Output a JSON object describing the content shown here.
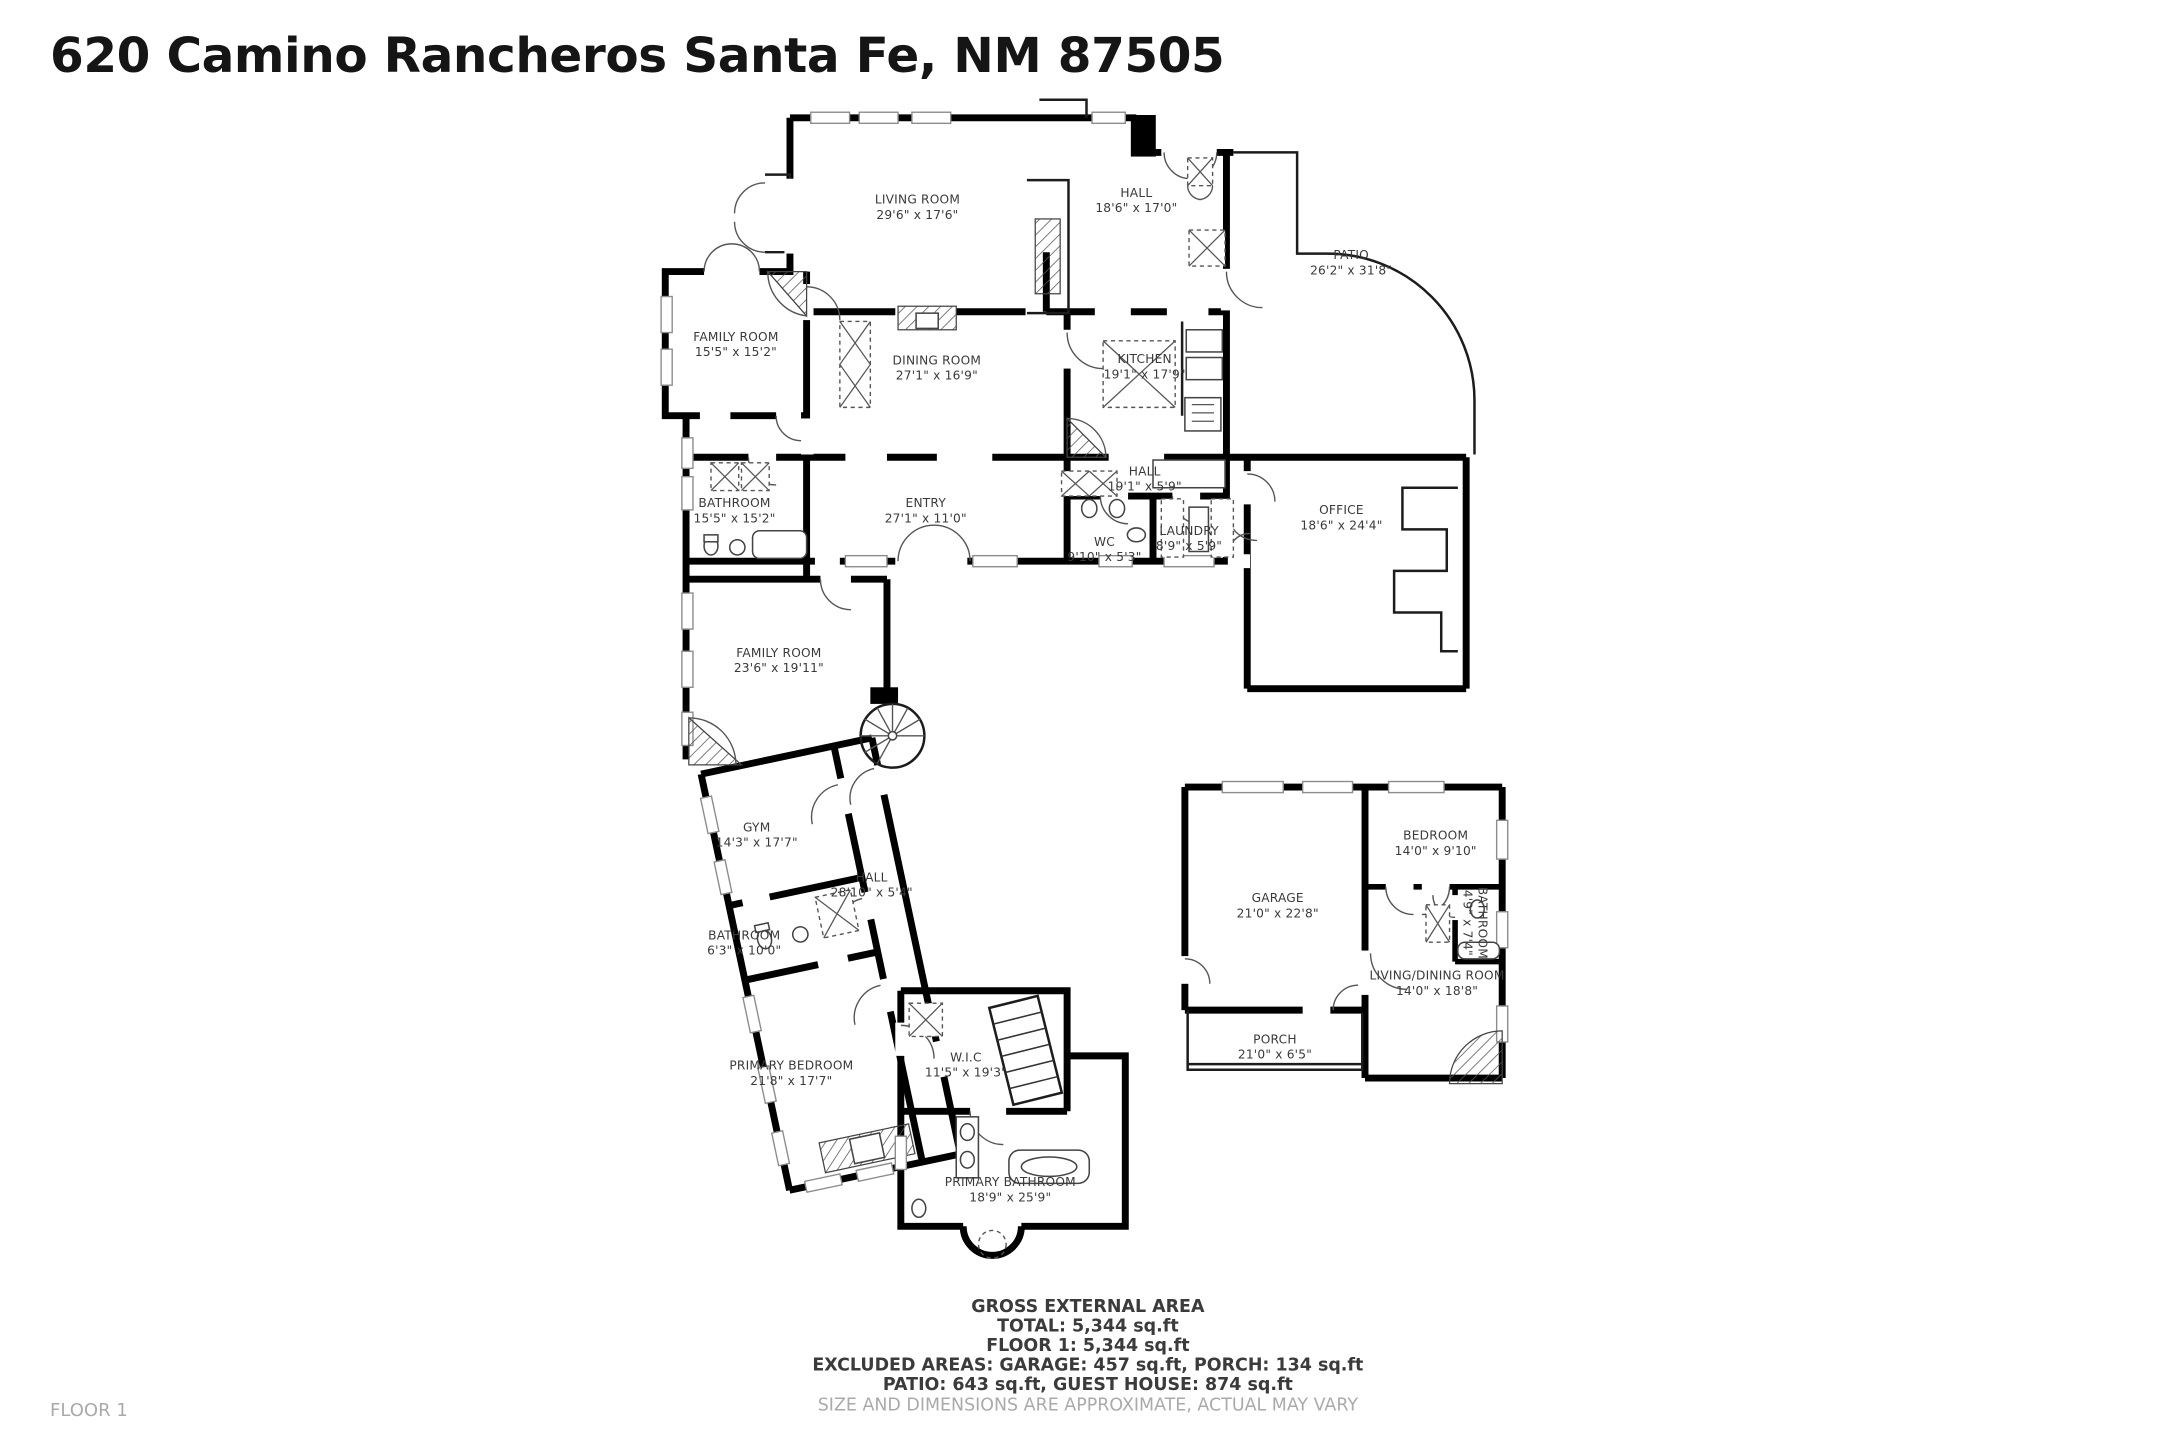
{
  "title": "620 Camino Rancheros Santa Fe, NM 87505",
  "floor_label": "FLOOR 1",
  "colors": {
    "walls": "#000000",
    "room_text": "#3a3a3a",
    "muted_text": "#aaaaaa",
    "background": "#ffffff"
  },
  "rooms": [
    {
      "name": "LIVING ROOM",
      "dims": "29'6\" x 17'6\""
    },
    {
      "name": "HALL",
      "dims": "18'6\" x 17'0\""
    },
    {
      "name": "FAMILY ROOM",
      "dims": "15'5\" x 15'2\""
    },
    {
      "name": "DINING ROOM",
      "dims": "27'1\" x 16'9\""
    },
    {
      "name": "KITCHEN",
      "dims": "19'1\" x 17'9\""
    },
    {
      "name": "PATIO",
      "dims": "26'2\" x 31'8\""
    },
    {
      "name": "OFFICE",
      "dims": "18'6\" x 24'4\""
    },
    {
      "name": "BATHROOM",
      "dims": "15'5\" x 15'2\""
    },
    {
      "name": "ENTRY",
      "dims": "27'1\" x 11'0\""
    },
    {
      "name": "HALL",
      "dims": "19'1\" x 5'9\""
    },
    {
      "name": "WC",
      "dims": "9'10\" x 5'3\""
    },
    {
      "name": "LAUNDRY",
      "dims": "8'9\" x 5'9\""
    },
    {
      "name": "FAMILY ROOM",
      "dims": "23'6\" x 19'11\""
    },
    {
      "name": "GYM",
      "dims": "14'3\" x 17'7\""
    },
    {
      "name": "HALL",
      "dims": "28'10\" x 5'4\""
    },
    {
      "name": "BATHROOM",
      "dims": "6'3\" x 10'0\""
    },
    {
      "name": "PRIMARY BEDROOM",
      "dims": "21'8\" x 17'7\""
    },
    {
      "name": "W.I.C",
      "dims": "11'5\" x 19'3\""
    },
    {
      "name": "PRIMARY BATHROOM",
      "dims": "18'9\" x 25'9\""
    },
    {
      "name": "GARAGE",
      "dims": "21'0\" x 22'8\""
    },
    {
      "name": "PORCH",
      "dims": "21'0\" x 6'5\""
    },
    {
      "name": "BEDROOM",
      "dims": "14'0\" x 9'10\""
    },
    {
      "name": "BATHROOM",
      "dims": "4'9\" x 7'4\""
    },
    {
      "name": "LIVING/DINING ROOM",
      "dims": "14'0\" x 18'8\""
    }
  ],
  "summary": {
    "heading": "GROSS EXTERNAL AREA",
    "line1": "TOTAL: 5,344 sq.ft",
    "line2": "FLOOR 1: 5,344 sq.ft",
    "line3": "EXCLUDED AREAS: GARAGE: 457 sq.ft, PORCH: 134 sq.ft",
    "line4": "PATIO: 643 sq.ft, GUEST HOUSE: 874 sq.ft",
    "disclaimer": "SIZE AND DIMENSIONS ARE APPROXIMATE, ACTUAL MAY VARY"
  }
}
